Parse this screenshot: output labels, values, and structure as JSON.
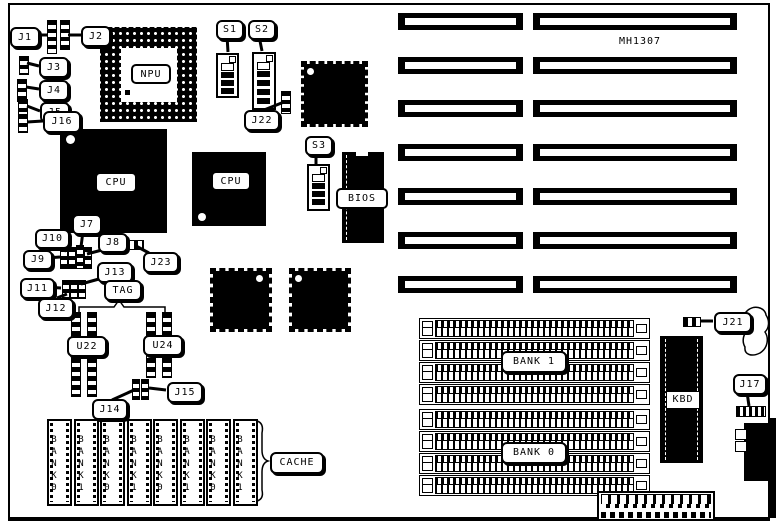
{
  "board": {
    "model_label": "MH1307"
  },
  "callouts": {
    "j1": "J1",
    "j2": "J2",
    "j3": "J3",
    "j4": "J4",
    "j5": "J5",
    "j16": "J16",
    "s1": "S1",
    "s2": "S2",
    "s3": "S3",
    "j22": "J22",
    "j23": "J23",
    "j7": "J7",
    "j8": "J8",
    "j9": "J9",
    "j10": "J10",
    "j11": "J11",
    "j12": "J12",
    "j13": "J13",
    "tag": "TAG",
    "j14": "J14",
    "j15": "J15",
    "j17": "J17",
    "j21": "J21",
    "cache": "CACHE"
  },
  "chips": {
    "npu": "NPU",
    "cpu_main": "CPU",
    "cpu_secondary": "CPU",
    "bios": "BIOS",
    "kbd": "KBD",
    "u22": "U22",
    "u24": "U24"
  },
  "memory": {
    "bank1_label": "BANK 1",
    "bank0_label": "BANK 0",
    "cache_chip_labels": [
      "BANK0",
      "BANK1",
      "BANK0",
      "BANK1",
      "BANK0",
      "BANK1",
      "BANK0",
      "BANK1"
    ]
  }
}
